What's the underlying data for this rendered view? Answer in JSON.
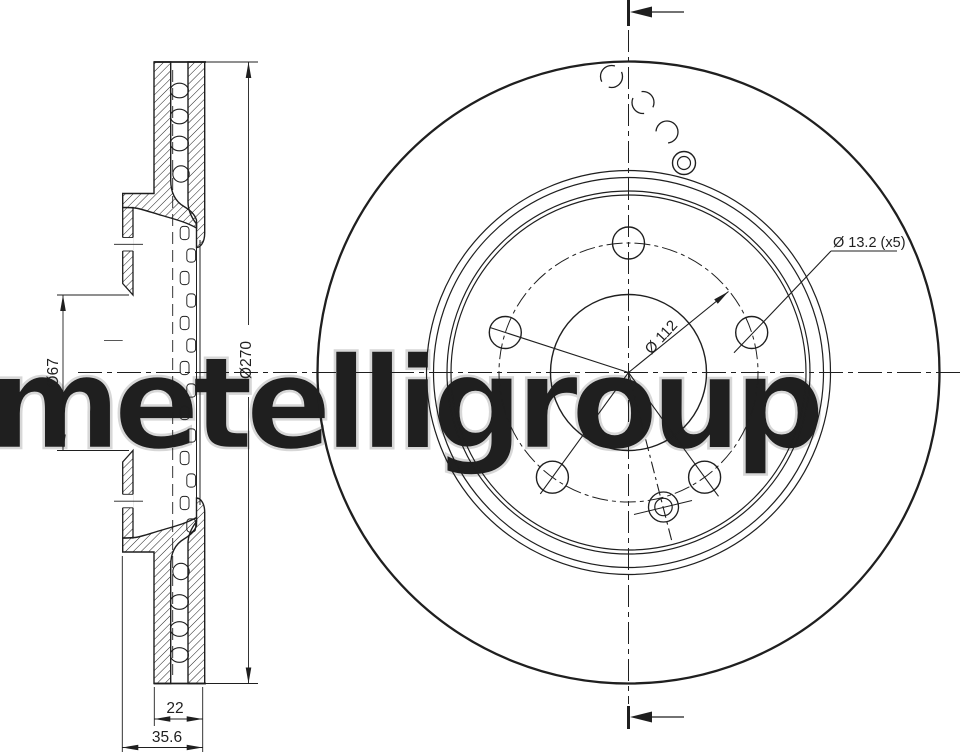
{
  "title": "Brake disc technical drawing",
  "watermark": "metelligroup",
  "labels": {
    "bore": "Ø67",
    "outer": "Ø270",
    "thickness": "22",
    "height": "35.6",
    "bolt_circle": "Ø 112",
    "bolt_holes": "Ø 13.2 (x5)"
  },
  "colors": {
    "line": "#1f1f1f",
    "watermark": "#d7d7d7",
    "background": "#ffffff"
  }
}
